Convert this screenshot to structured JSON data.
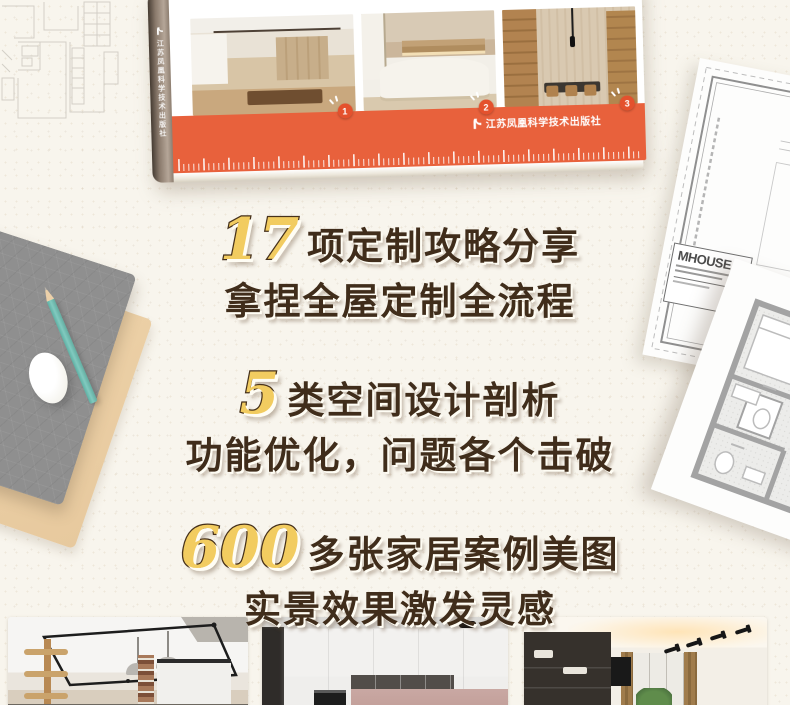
{
  "colors": {
    "background": "#f8f5ed",
    "accent_orange": "#e8613c",
    "badge_orange": "#e4512d",
    "gold_number": "#f2cc60",
    "headline_text": "#402d1b"
  },
  "book": {
    "publisher": "江苏凤凰科学技术出版社",
    "publisher_logo_icon": "phoenix-bird",
    "photo_badges": [
      "1",
      "2",
      "3"
    ]
  },
  "highlights": [
    {
      "number": "17",
      "line1_suffix": "项定制攻略分享",
      "line2": "拿捏全屋定制全流程"
    },
    {
      "number": "5",
      "line1_suffix": "类空间设计剖析",
      "line2": "功能优化，问题各个击破"
    },
    {
      "number": "600",
      "line1_suffix": "多张家居案例美图",
      "line2": "实景效果激发灵感"
    }
  ],
  "blueprint": {
    "logo_text": "MHOUSE"
  }
}
